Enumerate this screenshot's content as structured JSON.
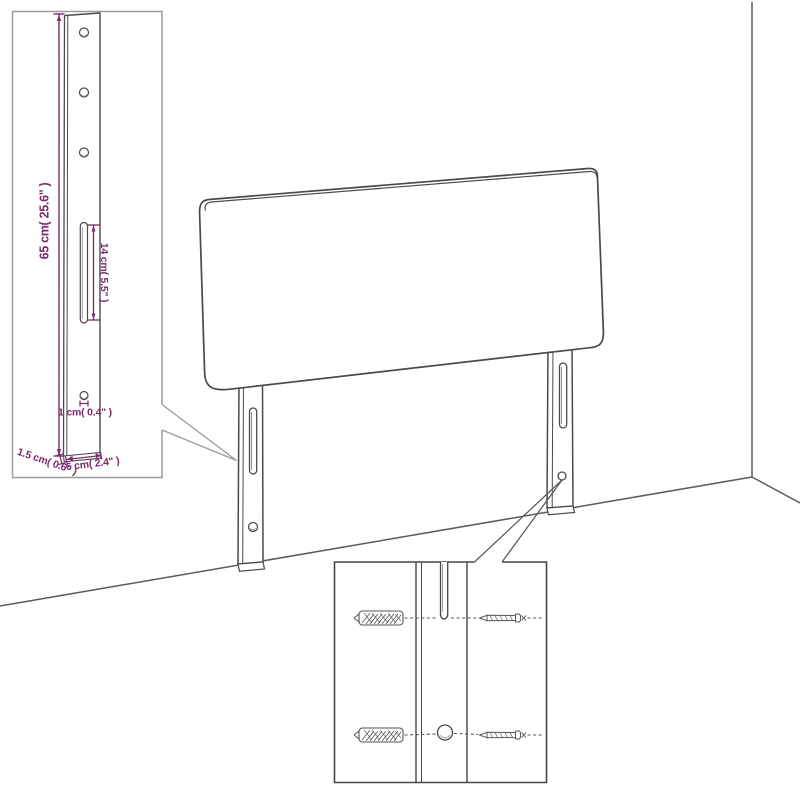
{
  "dims": {
    "leg_height": "65 cm( 25.6\" )",
    "slot_length": "14 cm( 5.5\" )",
    "hole_diameter": "1 cm( 0.4\" )",
    "leg_thickness": "1.5 cm( 0.6\" )",
    "leg_width": "6 cm( 2.4\" )"
  },
  "colors": {
    "dimension_text": "#7e2a6d",
    "outline_dark": "#4a4a4a",
    "outline_mid": "#5a5a5a",
    "inset_border_light": "#9b9b9b",
    "inset_border_dark": "#474747"
  },
  "icons": {
    "wall_plug": "wall-plug-anchor-icon",
    "screw": "screw-icon"
  }
}
